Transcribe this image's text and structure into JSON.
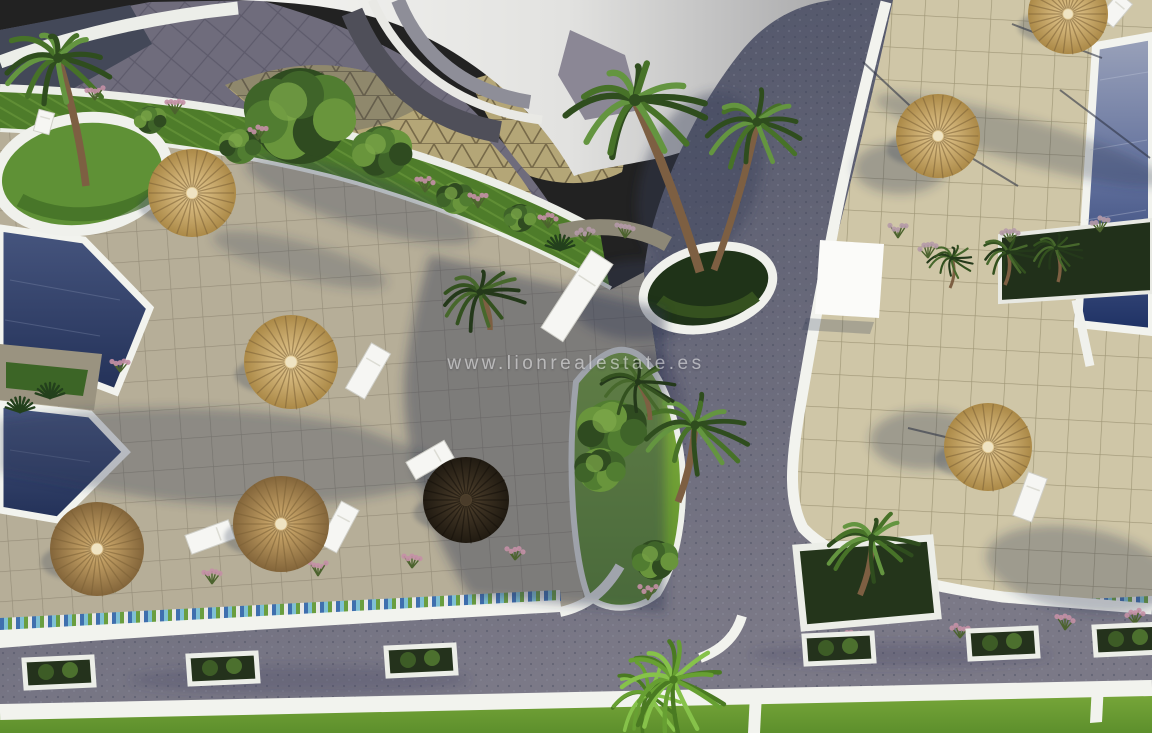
{
  "scene": {
    "type": "aerial-3d-architectural-render",
    "subject": "resort pool and garden complex, bird's-eye view",
    "watermark": {
      "text": "www.lionrealestate.es"
    }
  },
  "palette": {
    "roof_white": "#f0f0ed",
    "deck_left": "#b6ae98",
    "deck_right": "#cfc6a7",
    "road": "#5c6173",
    "pool_dark": "#26355e",
    "pool_light": "#9aa2ba",
    "lawn": "#76a437",
    "hedge": "#4e7c2a",
    "straw_light": "#c7a96e",
    "straw_dark": "#33291d",
    "curb_white": "#f2f3ee",
    "shadow": "#2e3a52",
    "flower_pink": "#c490a6",
    "plume_gray": "#b59aa8",
    "trunk": "#7d5f42"
  },
  "elements": {
    "parasols": [
      [
        192,
        193,
        44,
        "light"
      ],
      [
        291,
        362,
        47,
        "light"
      ],
      [
        97,
        549,
        47,
        "mid"
      ],
      [
        281,
        524,
        48,
        "mid"
      ],
      [
        466,
        500,
        43,
        "dark"
      ],
      [
        938,
        136,
        42,
        "light"
      ],
      [
        1068,
        14,
        40,
        "light"
      ],
      [
        988,
        447,
        44,
        "light"
      ]
    ],
    "loungers": [
      [
        88,
        550,
        22,
        58,
        24
      ],
      [
        210,
        537,
        20,
        46,
        70
      ],
      [
        339,
        527,
        20,
        48,
        28
      ],
      [
        368,
        371,
        22,
        52,
        30
      ],
      [
        430,
        460,
        20,
        44,
        60
      ],
      [
        1030,
        497,
        20,
        46,
        20
      ],
      [
        577,
        296,
        26,
        92,
        33
      ],
      [
        1116,
        10,
        18,
        30,
        40
      ],
      [
        44,
        122,
        16,
        22,
        15
      ]
    ],
    "palms": [
      [
        635,
        100,
        1.5,
        "mid",
        700,
        272
      ],
      [
        757,
        122,
        1.15,
        "mid",
        714,
        270
      ],
      [
        58,
        58,
        1.25,
        "mid",
        86,
        186
      ],
      [
        695,
        425,
        1.15,
        "mid",
        678,
        502
      ],
      [
        638,
        382,
        0.8,
        "dark",
        650,
        420
      ],
      [
        480,
        292,
        0.9,
        "dark",
        490,
        330
      ],
      [
        872,
        538,
        1.0,
        "mid",
        860,
        595
      ],
      [
        1008,
        252,
        0.6,
        "dark",
        1005,
        285
      ],
      [
        1056,
        248,
        0.55,
        "dark",
        1058,
        282
      ],
      [
        952,
        258,
        0.5,
        "dark",
        950,
        288
      ]
    ],
    "fan_palms": [
      [
        663,
        688,
        1.05
      ]
    ],
    "bushes": [
      [
        300,
        116,
        48
      ],
      [
        382,
        152,
        26
      ],
      [
        240,
        146,
        18
      ],
      [
        455,
        198,
        16
      ],
      [
        520,
        218,
        14
      ],
      [
        150,
        120,
        14
      ],
      [
        612,
        430,
        30
      ],
      [
        600,
        470,
        22
      ],
      [
        655,
        560,
        20
      ]
    ],
    "flowers": [
      [
        95,
        100,
        "pink"
      ],
      [
        175,
        114,
        "pink"
      ],
      [
        258,
        140,
        "pink"
      ],
      [
        425,
        192,
        "pink"
      ],
      [
        478,
        208,
        "pink"
      ],
      [
        548,
        228,
        "pink"
      ],
      [
        120,
        372,
        "pink"
      ],
      [
        115,
        592,
        "pink"
      ],
      [
        212,
        584,
        "pink"
      ],
      [
        318,
        576,
        "pink"
      ],
      [
        412,
        568,
        "pink"
      ],
      [
        515,
        560,
        "pink"
      ],
      [
        648,
        600,
        "pink"
      ],
      [
        855,
        646,
        "pink"
      ],
      [
        960,
        638,
        "pink"
      ],
      [
        1065,
        630,
        "pink"
      ],
      [
        1135,
        624,
        "pink"
      ],
      [
        898,
        238,
        "grass"
      ],
      [
        928,
        258,
        "grass"
      ],
      [
        1010,
        242,
        "grass"
      ],
      [
        1100,
        232,
        "grass"
      ],
      [
        585,
        242,
        "grass"
      ],
      [
        625,
        238,
        "grass"
      ]
    ],
    "agaves": [
      [
        50,
        398
      ],
      [
        20,
        412
      ],
      [
        560,
        250
      ]
    ],
    "road_planters": [
      [
        58,
        672
      ],
      [
        222,
        668
      ],
      [
        420,
        660
      ],
      [
        838,
        648
      ],
      [
        1002,
        643
      ],
      [
        1128,
        639
      ]
    ],
    "pole_shadows": [
      [
        942,
        140,
        1018,
        186
      ],
      [
        863,
        62,
        936,
        130
      ],
      [
        1012,
        24,
        1102,
        58
      ],
      [
        908,
        428,
        983,
        446
      ],
      [
        1060,
        90,
        1150,
        158
      ]
    ]
  }
}
